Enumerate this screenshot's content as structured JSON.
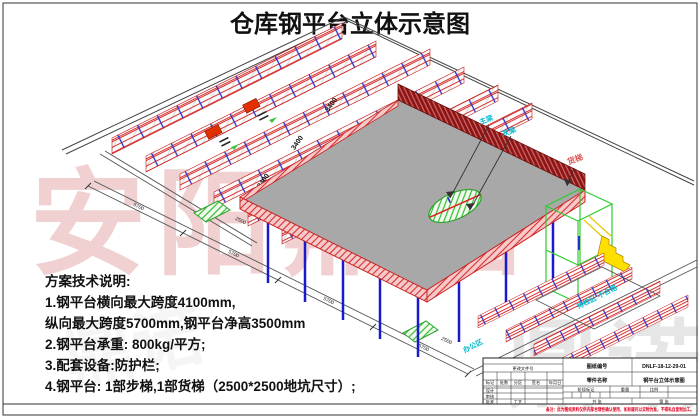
{
  "sheet": {
    "title": "仓库钢平台立体示意图"
  },
  "watermark": {
    "company": "安阳鼎诺",
    "company_short": "鼎诺"
  },
  "notes": {
    "heading": "方案技术说明:",
    "lines": [
      "1.钢平台横向最大跨度4100mm,",
      "纵向最大跨度5700mm,钢平台净高3500mm",
      "2.钢平台承重: 800kg/平方;",
      "3.配套设备:防护栏;",
      "4.钢平台: 1部步梯,1部货梯（2500*2500地坑尺寸）;"
    ]
  },
  "scene": {
    "beam_main": "主梁",
    "beam_secondary": "次梁",
    "freight_elevator": "货梯",
    "area_inspection": "待检区 不合格",
    "area_office": "办公区",
    "dim_rack_bay": "3400",
    "dim_long_span": "5700",
    "dim_pit": "2500"
  },
  "title_block": {
    "drawing_no_label": "图纸编号",
    "drawing_no": "DNLF-18-12-29-01",
    "part_name_label": "零件名称",
    "part_name": "钢平台立体示意图",
    "stage_label": "阶段标记",
    "weight_label": "重量",
    "scale_label": "比例",
    "sheet_total": "共 张",
    "sheet_index": "第 张",
    "change_doc_label": "更改文件号",
    "mark_label": "标记",
    "count_label": "处数",
    "zone_label": "分区",
    "sign_label": "签名",
    "date_label": "年月日",
    "design_label": "设计",
    "check_label": "审核",
    "process_label": "工艺",
    "approve_label": "批准",
    "red_note": "备注：此为图纸资料仅供内部合理性确认使用，如有疑问以实物为准，不得私自复制加工。"
  },
  "colors": {
    "rack_red": "#d83030",
    "column_blue": "#1a1acc",
    "parapet_dark_red": "#8c1414",
    "platform_gray": "#a8a8a8",
    "elevator_green": "#2ecc2e",
    "stair_yellow": "#ffdf00",
    "label_cyan": "#00b8cc",
    "watermark_pink": "#e2a2a2"
  }
}
